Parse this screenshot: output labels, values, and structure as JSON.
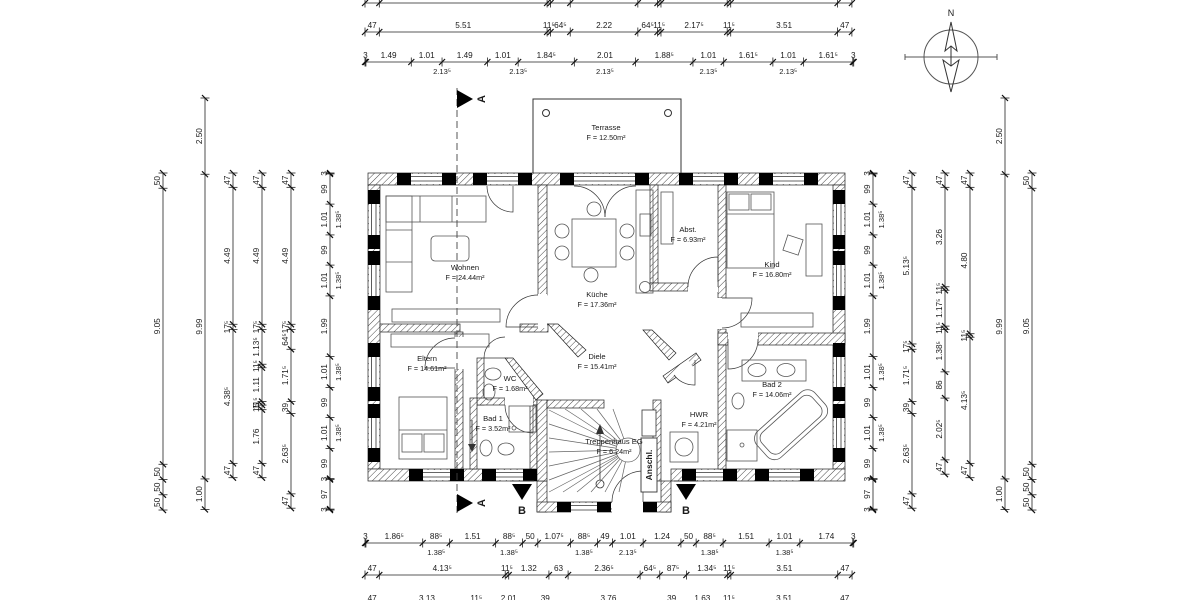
{
  "drawing": {
    "compass_label": "N",
    "section_a_label": "A",
    "section_b_label": "B",
    "anschl_label": "Anschl.",
    "rooms": [
      {
        "name": "Terrasse",
        "area": "F = 12.50m²",
        "x": 606,
        "y": 130
      },
      {
        "name": "Wohnen",
        "area": "F = 24.44m²",
        "x": 465,
        "y": 270
      },
      {
        "name": "Küche",
        "area": "F = 17.36m²",
        "x": 597,
        "y": 297
      },
      {
        "name": "Abst.",
        "area": "F = 6.93m²",
        "x": 688,
        "y": 232
      },
      {
        "name": "Kind",
        "area": "F = 16.80m²",
        "x": 772,
        "y": 267
      },
      {
        "name": "Eltern",
        "area": "F = 14.61m²",
        "x": 427,
        "y": 361
      },
      {
        "name": "Diele",
        "area": "F = 15.41m²",
        "x": 597,
        "y": 359
      },
      {
        "name": "WC",
        "area": "F = 1.68m²",
        "x": 510,
        "y": 381
      },
      {
        "name": "Bad 1",
        "area": "F = 3.52m²",
        "x": 493,
        "y": 421
      },
      {
        "name": "Bad 2",
        "area": "F = 14.06m²",
        "x": 772,
        "y": 387
      },
      {
        "name": "HWR",
        "area": "F = 4.21m²",
        "x": 699,
        "y": 417
      },
      {
        "name": "Treppenhaus EG",
        "area": "F = 6.24m²",
        "x": 614,
        "y": 444
      }
    ]
  },
  "dims": {
    "h_scale": 30.45,
    "v_scale": 30.5,
    "h": [
      {
        "name": "top-row-0",
        "x0": 365,
        "y": 3,
        "ticks_only": true,
        "segs": [
          [
            "47",
            0.47
          ],
          [
            "5.51",
            5.51
          ],
          [
            "11⁵",
            0.115
          ],
          [
            "64⁵",
            0.645
          ],
          [
            "2.22",
            2.22
          ],
          [
            "64⁵",
            0.645
          ],
          [
            "11⁵",
            0.115
          ],
          [
            "2.17⁵",
            2.175
          ],
          [
            "11⁵",
            0.115
          ],
          [
            "3.51",
            3.51
          ],
          [
            "47",
            0.47
          ]
        ]
      },
      {
        "name": "top-row-1",
        "x0": 365,
        "y": 32,
        "segs": [
          [
            "47",
            0.47
          ],
          [
            "5.51",
            5.51
          ],
          [
            "11⁵",
            0.115
          ],
          [
            "64⁵",
            0.645
          ],
          [
            "2.22",
            2.22
          ],
          [
            "64⁵",
            0.645
          ],
          [
            "11⁵",
            0.115
          ],
          [
            "2.17⁵",
            2.175
          ],
          [
            "11⁵",
            0.115
          ],
          [
            "3.51",
            3.51
          ],
          [
            "47",
            0.47
          ]
        ]
      },
      {
        "name": "top-row-2",
        "x0": 365,
        "y": 62,
        "segs": [
          [
            "3",
            0.03
          ],
          [
            "1.49",
            1.49
          ],
          [
            "1.01",
            1.01
          ],
          [
            "1.49",
            1.49
          ],
          [
            "1.01",
            1.01
          ],
          [
            "1.84⁵",
            1.845
          ],
          [
            "2.01",
            2.01
          ],
          [
            "1.88⁵",
            1.885
          ],
          [
            "1.01",
            1.01
          ],
          [
            "1.61⁵",
            1.615
          ],
          [
            "1.01",
            1.01
          ],
          [
            "1.61⁵",
            1.615
          ],
          [
            "3",
            0.03
          ]
        ],
        "subs": [
          [
            "2.13⁵",
            2.53
          ],
          [
            "2.13⁵",
            5.03
          ],
          [
            "2.13⁵",
            7.88
          ],
          [
            "2.13⁵",
            11.28
          ],
          [
            "2.13⁵",
            13.9
          ]
        ]
      },
      {
        "name": "bottom-row-1",
        "x0": 365,
        "y": 543,
        "segs": [
          [
            "3",
            0.03
          ],
          [
            "1.86⁵",
            1.865
          ],
          [
            "88⁵",
            0.885
          ],
          [
            "1.51",
            1.51
          ],
          [
            "88⁵",
            0.885
          ],
          [
            "50",
            0.5
          ],
          [
            "1.07⁵",
            1.075
          ],
          [
            "88⁵",
            0.885
          ],
          [
            "49",
            0.49
          ],
          [
            "1.01",
            1.01
          ],
          [
            "1.24",
            1.24
          ],
          [
            "50",
            0.5
          ],
          [
            "88⁵",
            0.885
          ],
          [
            "1.51",
            1.51
          ],
          [
            "1.01",
            1.01
          ],
          [
            "1.74",
            1.74
          ],
          [
            "3",
            0.03
          ]
        ],
        "subs": [
          [
            "1.38⁵",
            2.34
          ],
          [
            "1.38⁵",
            4.73
          ],
          [
            "1.38⁵",
            7.19
          ],
          [
            "2.13⁵",
            8.63
          ],
          [
            "1.38⁵",
            11.32
          ],
          [
            "1.38⁵",
            13.78
          ]
        ]
      },
      {
        "name": "bottom-row-2",
        "x0": 365,
        "y": 575,
        "segs": [
          [
            "47",
            0.47
          ],
          [
            "4.13⁵",
            4.135
          ],
          [
            "11⁵",
            0.115
          ],
          [
            "1.32",
            1.32
          ],
          [
            "63",
            0.63
          ],
          [
            "2.36⁵",
            2.365
          ],
          [
            "64⁵",
            0.645
          ],
          [
            "87⁵",
            0.875
          ],
          [
            "1.34⁵",
            1.345
          ],
          [
            "11⁵",
            0.115
          ],
          [
            "3.51",
            3.51
          ],
          [
            "47",
            0.47
          ]
        ]
      },
      {
        "name": "bottom-row-3",
        "x0": 365,
        "y": 605,
        "segs": [
          [
            "47",
            0.47
          ],
          [
            "3.13",
            3.13
          ],
          [
            "11⁵",
            0.115
          ],
          [
            "2.01",
            2.01
          ],
          [
            "39",
            0.39
          ],
          [
            "3.76",
            3.76
          ],
          [
            "39",
            0.39
          ],
          [
            "1.63",
            1.63
          ],
          [
            "11⁵",
            0.115
          ],
          [
            "3.51",
            3.51
          ],
          [
            "47",
            0.47
          ]
        ]
      }
    ],
    "v": [
      {
        "name": "left-col-a",
        "x": 163,
        "y0": 173,
        "segs": [
          [
            "50",
            0.5
          ],
          [
            "9.05",
            9.05
          ],
          [
            "50",
            0.5
          ],
          [
            "50",
            0.5
          ],
          [
            "50",
            0.5
          ]
        ]
      },
      {
        "name": "left-col-b",
        "x": 205,
        "y0": 98,
        "segs": [
          [
            "2.50",
            2.5
          ],
          [
            "9.99",
            9.99
          ],
          [
            "1.00",
            1.0
          ]
        ]
      },
      {
        "name": "left-col-c",
        "x": 233,
        "y0": 173,
        "segs": [
          [
            "47",
            0.47
          ],
          [
            "4.49",
            4.49
          ],
          [
            "17⁵",
            0.175
          ],
          [
            "4.38⁵",
            4.385
          ],
          [
            "47",
            0.47
          ]
        ]
      },
      {
        "name": "left-col-d",
        "x": 262,
        "y0": 173,
        "segs": [
          [
            "47",
            0.47
          ],
          [
            "4.49",
            4.49
          ],
          [
            "17⁵",
            0.175
          ],
          [
            "1.13⁵",
            1.135
          ],
          [
            "11⁵",
            0.115
          ],
          [
            "1.11",
            1.11
          ],
          [
            "11⁵",
            0.115
          ],
          [
            "15",
            0.15
          ],
          [
            "1.76",
            1.76
          ],
          [
            "47",
            0.47
          ]
        ]
      },
      {
        "name": "left-col-e",
        "x": 291,
        "y0": 173,
        "segs": [
          [
            "47",
            0.47
          ],
          [
            "4.49",
            4.49
          ],
          [
            "17⁵",
            0.175
          ],
          [
            "64⁵",
            0.645
          ],
          [
            "1.71⁵",
            1.715
          ],
          [
            "39",
            0.39
          ],
          [
            "2.63⁵",
            2.635
          ],
          [
            "47",
            0.47
          ]
        ]
      },
      {
        "name": "left-col-f",
        "x": 330,
        "y0": 173,
        "segs": [
          [
            "3",
            0.03
          ],
          [
            "99",
            0.99
          ],
          [
            "1.01",
            1.01
          ],
          [
            "99",
            0.99
          ],
          [
            "1.01",
            1.01
          ],
          [
            "1.99",
            1.99
          ],
          [
            "1.01",
            1.01
          ],
          [
            "99",
            0.99
          ],
          [
            "1.01",
            1.01
          ],
          [
            "99",
            0.99
          ],
          [
            "3",
            0.03
          ],
          [
            "97",
            0.97
          ],
          [
            "3",
            0.03
          ]
        ],
        "subs": [
          [
            "1.38⁵",
            1.525
          ],
          [
            "1.38⁵",
            3.525
          ],
          [
            "1.38⁵",
            6.525
          ],
          [
            "1.38⁵",
            8.525
          ]
        ]
      },
      {
        "name": "right-col-g",
        "x": 873,
        "y0": 173,
        "segs": [
          [
            "3",
            0.03
          ],
          [
            "99",
            0.99
          ],
          [
            "1.01",
            1.01
          ],
          [
            "99",
            0.99
          ],
          [
            "1.01",
            1.01
          ],
          [
            "1.99",
            1.99
          ],
          [
            "1.01",
            1.01
          ],
          [
            "99",
            0.99
          ],
          [
            "1.01",
            1.01
          ],
          [
            "99",
            0.99
          ],
          [
            "3",
            0.03
          ],
          [
            "97",
            0.97
          ],
          [
            "3",
            0.03
          ]
        ],
        "subs": [
          [
            "1.38⁵",
            1.525
          ],
          [
            "1.38⁵",
            3.525
          ],
          [
            "1.38⁵",
            6.525
          ],
          [
            "1.38⁵",
            8.525
          ]
        ]
      },
      {
        "name": "right-col-h",
        "x": 912,
        "y0": 173,
        "segs": [
          [
            "47",
            0.47
          ],
          [
            "5.13⁵",
            5.135
          ],
          [
            "17⁵",
            0.175
          ],
          [
            "1.71⁵",
            1.715
          ],
          [
            "39",
            0.39
          ],
          [
            "2.63⁵",
            2.635
          ],
          [
            "47",
            0.47
          ]
        ]
      },
      {
        "name": "right-col-i",
        "x": 945,
        "y0": 173,
        "segs": [
          [
            "47",
            0.47
          ],
          [
            "3.26",
            3.26
          ],
          [
            "11⁵",
            0.115
          ],
          [
            "1.17⁵",
            1.175
          ],
          [
            "11⁵",
            0.115
          ],
          [
            "1.38⁵",
            1.385
          ],
          [
            "86",
            0.86
          ],
          [
            "2.02⁵",
            2.025
          ],
          [
            "47",
            0.47
          ]
        ]
      },
      {
        "name": "right-col-j",
        "x": 970,
        "y0": 173,
        "segs": [
          [
            "47",
            0.47
          ],
          [
            "4.80",
            4.8
          ],
          [
            "11⁵",
            0.115
          ],
          [
            "4.13⁵",
            4.135
          ],
          [
            "47",
            0.47
          ]
        ]
      },
      {
        "name": "right-col-k",
        "x": 1005,
        "y0": 98,
        "segs": [
          [
            "2.50",
            2.5
          ],
          [
            "9.99",
            9.99
          ],
          [
            "1.00",
            1.0
          ]
        ]
      },
      {
        "name": "right-col-l",
        "x": 1032,
        "y0": 173,
        "segs": [
          [
            "50",
            0.5
          ],
          [
            "9.05",
            9.05
          ],
          [
            "50",
            0.5
          ],
          [
            "50",
            0.5
          ],
          [
            "50",
            0.5
          ]
        ]
      }
    ]
  }
}
